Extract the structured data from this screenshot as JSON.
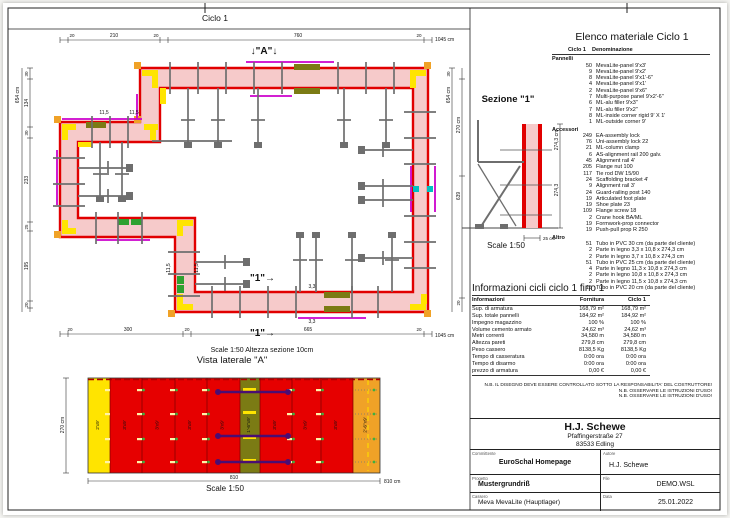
{
  "header": {
    "title": "Ciclo 1"
  },
  "plan": {
    "marker_a": "↓\"A\"↓",
    "cut_marker1": "\"1\"→",
    "cut_marker2": "\"1\"→",
    "scale_note": "Scale 1:50   Altezza sezione 10cm",
    "dims": {
      "top": [
        "20",
        "210",
        "20",
        "760",
        "20",
        "1045 cm"
      ],
      "left_total": "654 cm",
      "left": [
        "30",
        "134",
        "30",
        "233",
        "25",
        "195",
        "20"
      ],
      "right_total": "654 cm",
      "right": [
        "30",
        "270 cm",
        "639",
        "20"
      ],
      "bottom": [
        "20",
        "300",
        "20",
        "665",
        "20",
        "1045 cm"
      ]
    },
    "small_labels": [
      "11,5",
      "11,5",
      "11,5",
      "11,5",
      "3,3",
      "3,3"
    ]
  },
  "sezione": {
    "title": "Sezione \"1\"",
    "dim_outer": "274,3 cm",
    "dim_inner": "274,3",
    "dim_bottom": "25 cm",
    "scale": "Scale 1:50"
  },
  "lateral": {
    "title": "Vista laterale \"A\"",
    "height_dim": "270 cm",
    "panels": [
      "2'x9'",
      "3'x9'",
      "3'x9'",
      "3'x9'",
      "3'x9'",
      "1'-6\"x9'",
      "3'x9'",
      "3'x9'",
      "3'x9'",
      "2'-6\"x9'"
    ],
    "dim_mid": "810",
    "dim_right": "810 cm",
    "scale": "Scale 1:50"
  },
  "materials": {
    "title": "Elenco materiale  Ciclo 1",
    "col1": "Ciclo 1",
    "col2": "Denominazione",
    "sections": [
      {
        "title": "Pannelli",
        "items": [
          {
            "qty": "50",
            "name": "MevaLite-panel 9'x3'"
          },
          {
            "qty": "9",
            "name": "MevaLite-panel 9'x2'"
          },
          {
            "qty": "8",
            "name": "MevaLite-panel 9'x1'-6\""
          },
          {
            "qty": "4",
            "name": "MevaLite-panel 9'x1'"
          },
          {
            "qty": "2",
            "name": "MevaLite-panel 9'x6\""
          },
          {
            "qty": "7",
            "name": "Multi-purpose panel 9'x2'-6\""
          },
          {
            "qty": "6",
            "name": "ML-alu filler 9'x3\""
          },
          {
            "qty": "7",
            "name": "ML-alu filler 9'x2\""
          },
          {
            "qty": "8",
            "name": "ML-inside corner rigid 9' X 1'"
          },
          {
            "qty": "1",
            "name": "ML-outside corner 9'"
          }
        ]
      },
      {
        "title": "Accessori",
        "items": [
          {
            "qty": "249",
            "name": "EA-assembly lock"
          },
          {
            "qty": "76",
            "name": "Uni-assembly lock  22"
          },
          {
            "qty": "21",
            "name": "ML-column clamp"
          },
          {
            "qty": "6",
            "name": "AS-alignment rail 200   galv."
          },
          {
            "qty": "45",
            "name": "Alignment rail 4'"
          },
          {
            "qty": "205",
            "name": "Flange nut 100"
          },
          {
            "qty": "117",
            "name": "Tie rod DW 15/90"
          },
          {
            "qty": "24",
            "name": "Scaffolding bracket 4'"
          },
          {
            "qty": "9",
            "name": "Alignment rail 3'"
          },
          {
            "qty": "24",
            "name": "Guard-railing post 140"
          },
          {
            "qty": "19",
            "name": "Articulated foot plate"
          },
          {
            "qty": "19",
            "name": "Shoe plate 23"
          },
          {
            "qty": "109",
            "name": "Flange screw 18"
          },
          {
            "qty": "2",
            "name": "Crane hook BA/ML"
          },
          {
            "qty": "19",
            "name": "Formwork-prop connector"
          },
          {
            "qty": "19",
            "name": "Push-pull prop R 250"
          }
        ]
      },
      {
        "title": "Altro",
        "items": [
          {
            "qty": "51",
            "name": "Tubo in PVC 30 cm (da parte del cliente)"
          },
          {
            "qty": "2",
            "name": "Parte in legno 3,3 x 10,8 x 274,3 cm"
          },
          {
            "qty": "2",
            "name": "Parte in legno 3,7 x 10,8 x 274,3 cm"
          },
          {
            "qty": "51",
            "name": "Tubo in PVC 25 cm (da parte del cliente)"
          },
          {
            "qty": "4",
            "name": "Parte in legno 11,3 x 10,8 x 274,3 cm"
          },
          {
            "qty": "2",
            "name": "Parte in legno 10,8 x 10,8 x 274,3 cm"
          },
          {
            "qty": "2",
            "name": "Parte in legno 11,5 x 10,8 x 274,3 cm"
          },
          {
            "qty": "15",
            "name": "Tubo in PVC 20 cm (da parte del cliente)"
          }
        ]
      }
    ]
  },
  "info": {
    "title": "Informazioni cicli  ciclo 1 fino 1",
    "headers": [
      "Informazioni",
      "Fornitura",
      "Ciclo 1"
    ],
    "rows": [
      {
        "label": "Sup. di armatura",
        "f": "168,79 m²",
        "c": "168,79 m²"
      },
      {
        "label": "Sup. totale pannelli",
        "f": "184,92 m²",
        "c": "184,92 m²"
      },
      {
        "label": "Impegno magazzino",
        "f": "100 %",
        "c": "100 %"
      },
      {
        "label": "Volume cemento armato",
        "f": "24,62 m³",
        "c": "24,62 m³"
      },
      {
        "label": "Metri correnti",
        "f": "34,580 m",
        "c": "34,580 m"
      },
      {
        "label": "Altezza pareti",
        "f": "279,8 cm",
        "c": "279,8 cm"
      },
      {
        "label": "Peso cassero",
        "f": "8138,5 Kg",
        "c": "8138,5 Kg"
      },
      {
        "label": "Tempo di casseratura",
        "f": "0:00 ora",
        "c": "0:00 ora"
      },
      {
        "label": "Tempo di disarmo",
        "f": "0:00 ora",
        "c": "0:00 ora"
      },
      {
        "label": "prezzo di armatura",
        "f": "0,00 €",
        "c": "0,00 €"
      }
    ]
  },
  "notes": [
    "N.B. IL DISEGNO DEVE ESSERE CONTROLLATO SOTTO LA RESPONSABILITA' DEL COSTRUTTORE!",
    "N.B. OSSERVARE LE ISTRUZIONI D'USO!",
    "N.B. OSSERVARE LE ISTRUZIONI D'USO!"
  ],
  "titleblock": {
    "company": "H.J. Schewe",
    "address1": "Pfaffingerstraße 27",
    "address2": "83533 Edling",
    "committente_label": "Committente",
    "committente": "EuroSchal Homepage",
    "autore_label": "Autore",
    "autore": "H.J. Schewe",
    "progetto_label": "Progetto",
    "progetto": "Mustergrundriß",
    "file_label": "File",
    "file": "DEMO.WSL",
    "cassero_label": "Cassero",
    "cassero": "Meva MevaLite (Hauptlager)",
    "data_label": "Data",
    "data": "25.01.2022"
  },
  "colors": {
    "red": "#e10000",
    "pink": "#f6caca",
    "yellow": "#ffe400",
    "orange": "#f0a227",
    "olive": "#7b7b14",
    "magenta": "#cc00cc",
    "purple": "#4a0d73",
    "green": "#2fa12f",
    "teal": "#00c0c0",
    "gray": "#6e6e6e"
  }
}
